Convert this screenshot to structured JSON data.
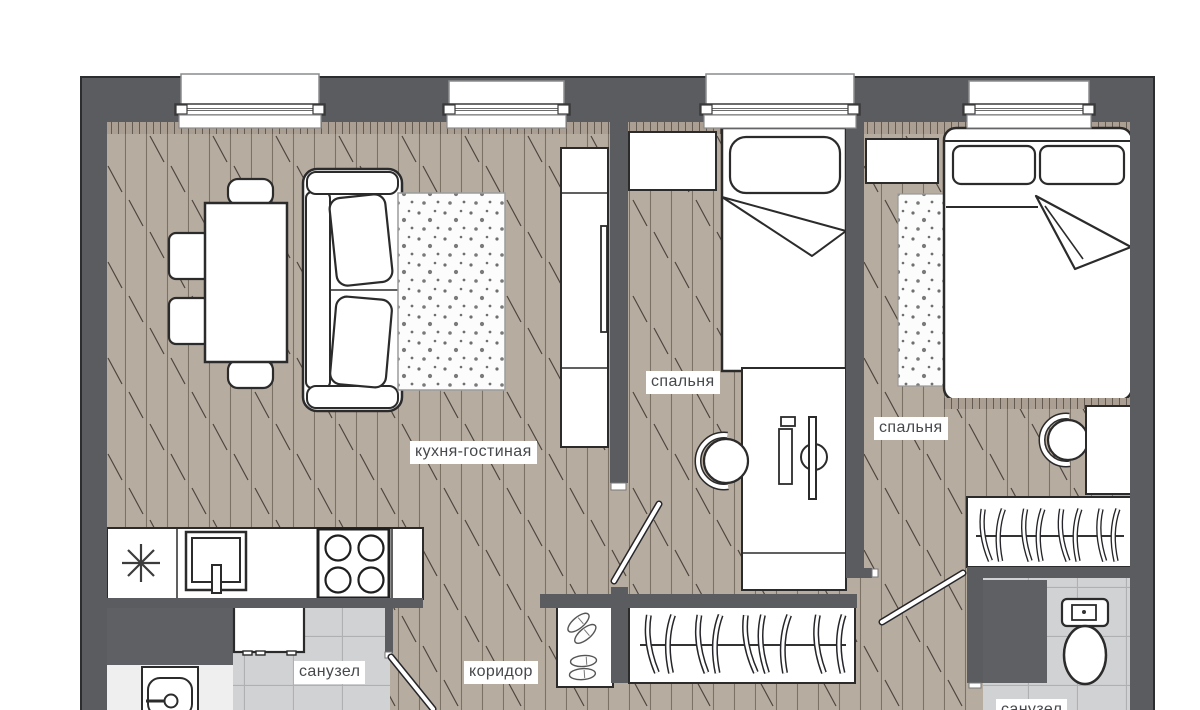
{
  "plan": {
    "type": "apartment-floor-plan",
    "labels": {
      "living": "кухня-гостиная",
      "bedroom1": "спальня",
      "bedroom2": "спальня",
      "bathroom1": "санузел",
      "corridor": "коридор",
      "bathroom2": "санузел"
    },
    "colors": {
      "wall": "#5b5c60",
      "wall_block": "#5f6064",
      "wood_floor": "#b7aca0",
      "tile_floor": "#d1d2d4",
      "furniture_outline": "#2b2b2b",
      "label_text": "#46484c",
      "background": "#ffffff"
    }
  }
}
